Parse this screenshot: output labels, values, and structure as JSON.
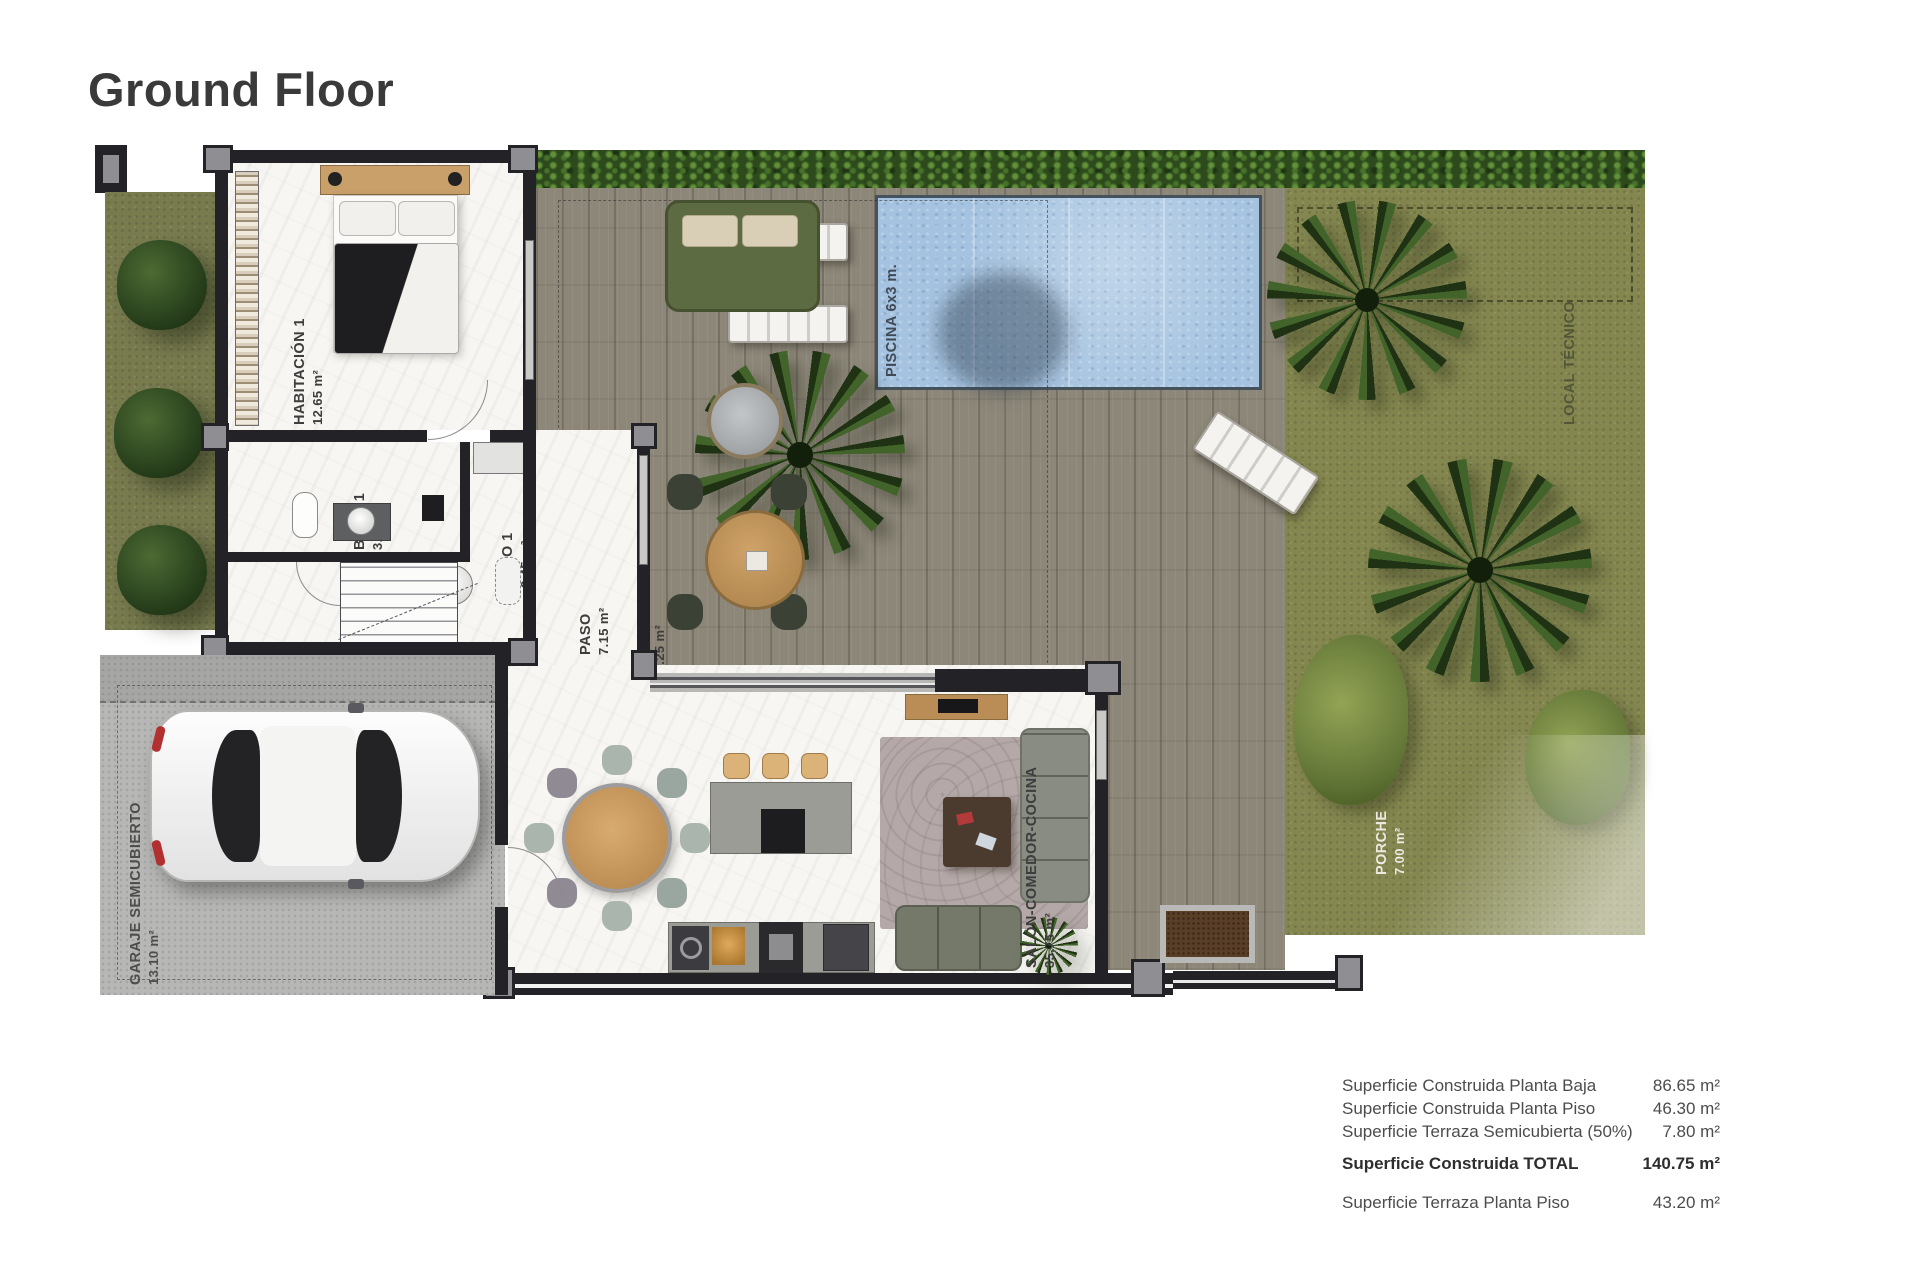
{
  "page": {
    "title": "Ground Floor"
  },
  "rooms": [
    {
      "name": "HABITACIÓN 1",
      "area": "12.65 m²"
    },
    {
      "name": "BAÑO 1",
      "area": "3.35 m²"
    },
    {
      "name": "ASEO 1",
      "area": "2.45 m²"
    },
    {
      "name": "PASO",
      "area": "7.15 m²"
    },
    {
      "name": "TERRAZA SEMICUBIERTA",
      "area": "18.25 m²"
    },
    {
      "name": "SALON-COMEDOR-COCINA",
      "area": "35.75 m²"
    },
    {
      "name": "GARAJE SEMICUBIERTO",
      "area": "13.10 m²"
    },
    {
      "name": "PORCHE",
      "area": "7.00 m²"
    },
    {
      "name": "PISCINA 6x3 m."
    },
    {
      "name": "LOCAL TÉCNICO"
    }
  ],
  "summary": {
    "rows": [
      {
        "label": "Superficie Construida Planta Baja",
        "value": "86.65 m²"
      },
      {
        "label": "Superficie Construida Planta Piso",
        "value": "46.30 m²"
      },
      {
        "label": "Superficie Terraza Semicubierta (50%)",
        "value": "7.80 m²"
      }
    ],
    "total": {
      "label": "Superficie Construida TOTAL",
      "value": "140.75 m²"
    },
    "extra": {
      "label": "Superficie Terraza Planta Piso",
      "value": "43.20 m²"
    }
  },
  "colors": {
    "wall": "#232327",
    "deck_wood": "#8d8779",
    "grass": "#787b4e",
    "pool_water": "#a5c3e0",
    "hedge": "#2c4a1c",
    "marble_floor": "#f7f6f2",
    "concrete": "#b7b7b5",
    "outdoor_sofa": "#5d6b43",
    "wood_furniture": "#c89a62"
  }
}
